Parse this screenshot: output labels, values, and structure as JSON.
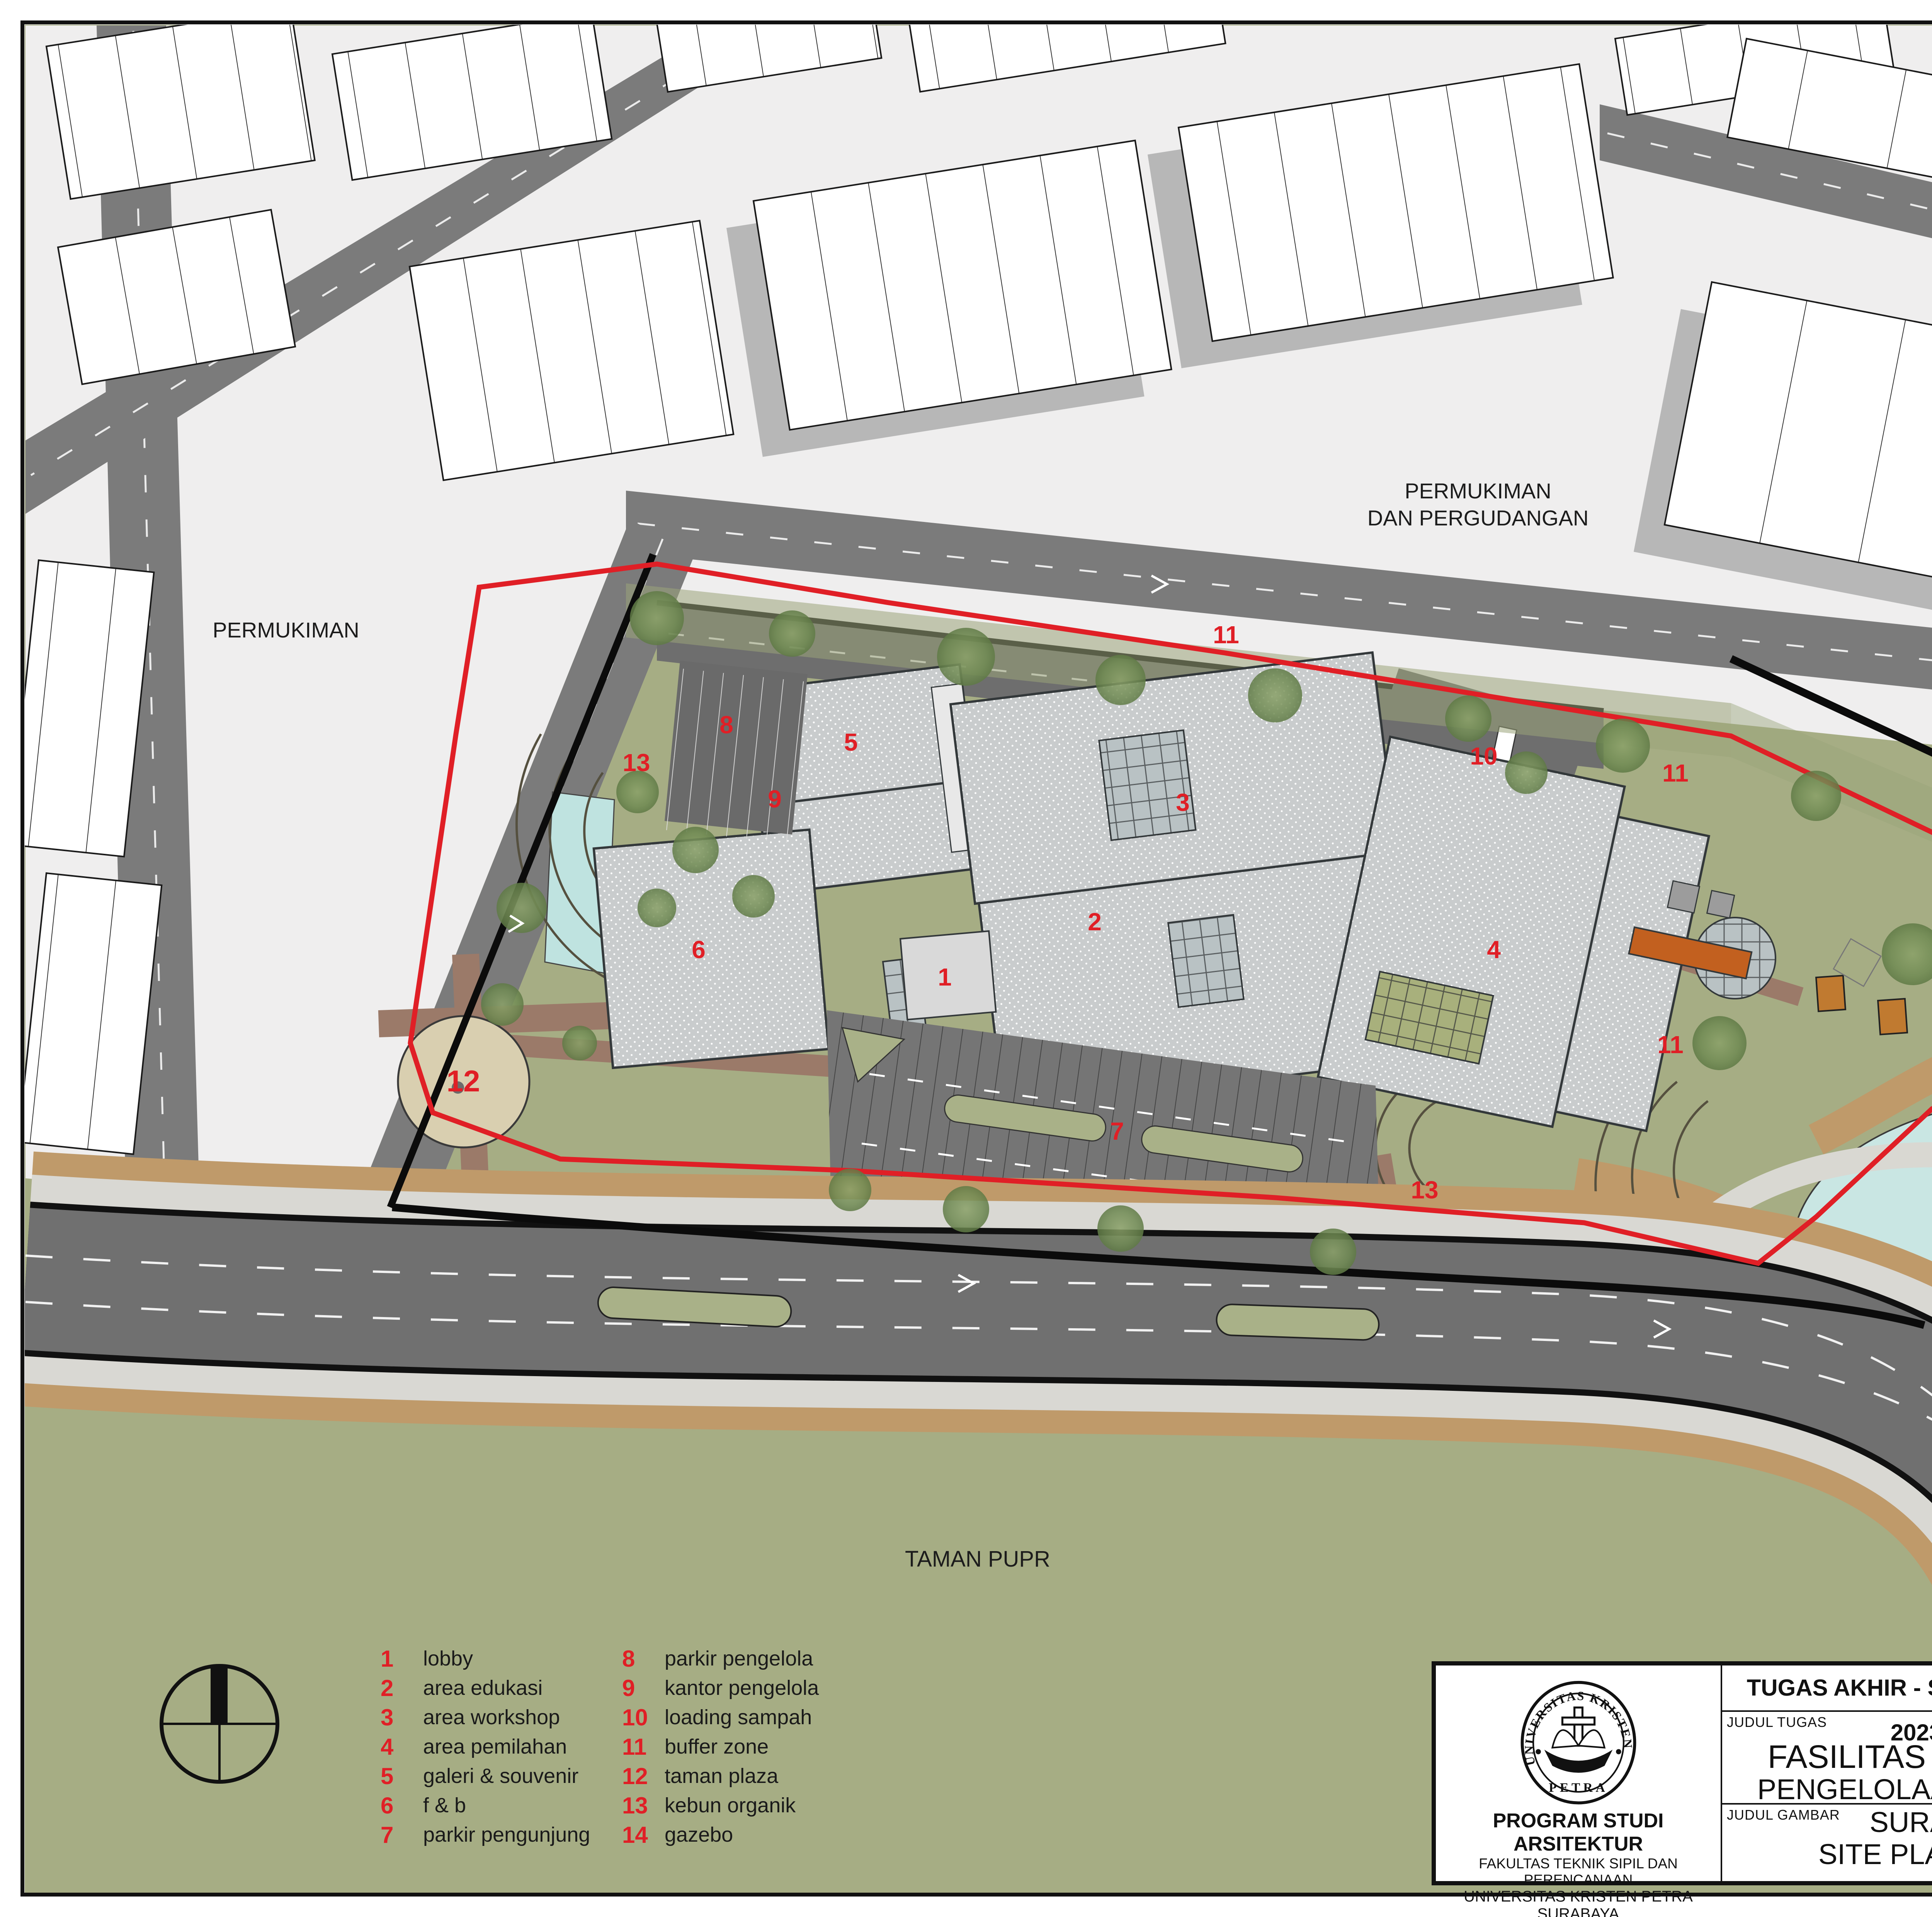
{
  "map": {
    "labels": {
      "permukiman_left": "PERMUKIMAN",
      "pergudangan_line1": "PERMUKIMAN",
      "pergudangan_line2": "DAN PERGUDANGAN",
      "kolam_line1": "KOLAM",
      "kolam_line2": "RETENSI",
      "taman": "TAMAN PUPR"
    },
    "markers": [
      {
        "num": "11"
      },
      {
        "num": "8"
      },
      {
        "num": "5"
      },
      {
        "num": "13"
      },
      {
        "num": "9"
      },
      {
        "num": "3"
      },
      {
        "num": "10"
      },
      {
        "num": "11"
      },
      {
        "num": "2"
      },
      {
        "num": "6"
      },
      {
        "num": "4"
      },
      {
        "num": "1"
      },
      {
        "num": "14"
      },
      {
        "num": "11"
      },
      {
        "num": "12"
      },
      {
        "num": "7"
      },
      {
        "num": "13"
      }
    ],
    "colors": {
      "grass": "#a6ad84",
      "urban": "#efeeee",
      "road": "#7b7b7b",
      "main_road": "#707070",
      "pond": "#c9e6e3",
      "roof": "#c9cccd",
      "red": "#e01f26",
      "tan_path": "#bf9a6a",
      "plaza": "#d9cfb0",
      "gazebo": "#c07a30"
    }
  },
  "legend": {
    "items": [
      {
        "num": "1",
        "label": "lobby"
      },
      {
        "num": "2",
        "label": "area edukasi"
      },
      {
        "num": "3",
        "label": "area workshop"
      },
      {
        "num": "4",
        "label": "area pemilahan"
      },
      {
        "num": "5",
        "label": "galeri & souvenir"
      },
      {
        "num": "6",
        "label": "f & b"
      },
      {
        "num": "7",
        "label": "parkir pengunjung"
      },
      {
        "num": "8",
        "label": "parkir pengelola"
      },
      {
        "num": "9",
        "label": "kantor pengelola"
      },
      {
        "num": "10",
        "label": "loading sampah"
      },
      {
        "num": "11",
        "label": "buffer zone"
      },
      {
        "num": "12",
        "label": "taman plaza"
      },
      {
        "num": "13",
        "label": "kebun organik"
      },
      {
        "num": "14",
        "label": "gazebo"
      }
    ]
  },
  "title_block": {
    "header": "TUGAS AKHIR - SEMESTER GENAP 2023/2024",
    "labels": {
      "judul_tugas": "JUDUL TUGAS",
      "judul_gambar": "JUDUL GAMBAR",
      "skala": "SKALA",
      "nama": "NAMA",
      "nrp": "NRP",
      "kelompok": "KELOMPOK",
      "mentor_utama": "MENTOR UTAMA",
      "mentor_pendamping": "MENTOR PENDAMPING",
      "lembar": "LEMBAR",
      "jumlah": "JUMLAH",
      "tanggal": "TANGGAL",
      "pengesahan": "PENGESAHAN"
    },
    "judul_tugas_line1": "FASILITAS EDUWISATA",
    "judul_tugas_line2": "PENGELOLAAN SAMPAH DI SURABAYA",
    "judul_gambar_value": "SITE PLAN",
    "skala_value": "1:700",
    "nama_value": "RICHARD JEVON",
    "nrp_value": "B12200024",
    "kelompok_value": "7",
    "mentor_utama_value": "ELVINA S. WIJAYA, S.T., M.T.",
    "mentor_pendamping_line1": "ALTREROSJE, S.T., M.T.",
    "mentor_pendamping_line2": "IR. SAMUEL HARTONO, M. SC.",
    "institution": {
      "line1": "PROGRAM STUDI ARSITEKTUR",
      "line2": "FAKULTAS TEKNIK SIPIL DAN PERENCANAAN",
      "line3": "UNIVERSITAS KRISTEN PETRA",
      "line4": "SURABAYA"
    },
    "logo": {
      "arc_text": "UNIVERSITAS KRISTEN",
      "bottom_text": "PETRA"
    }
  }
}
